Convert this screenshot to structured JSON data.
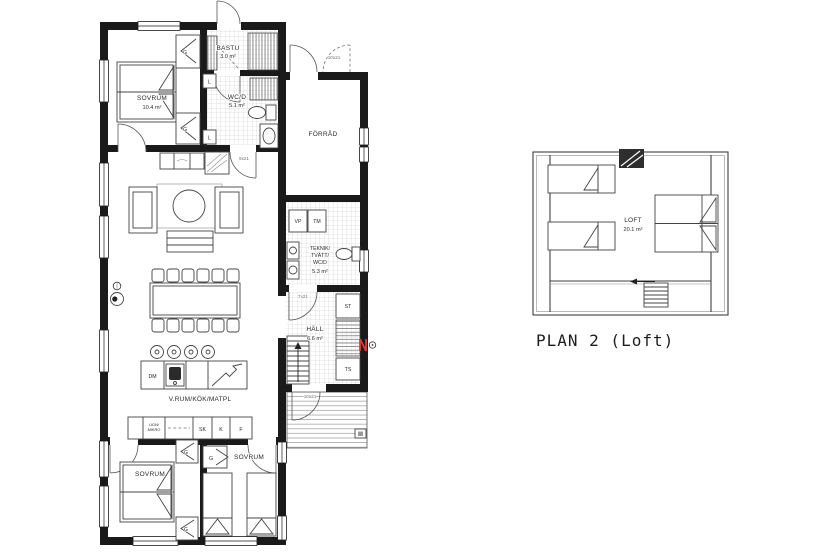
{
  "drawing": {
    "background": "#ffffff",
    "wall_color": "#1a1a1a",
    "line_color": "#3a3a3a",
    "tile_color": "#c9c9c9",
    "accent_red": "#e23b2e"
  },
  "plan1": {
    "rooms": {
      "sovrum_nw": {
        "label": "SOVRUM",
        "area": "10.4 m²"
      },
      "bastu": {
        "label": "BASTU",
        "area": "3.0 m²"
      },
      "wcd": {
        "label": "WC/D",
        "area": "5.1 m²"
      },
      "forrad": {
        "label": "FÖRRÅD"
      },
      "teknik": {
        "l1": "TEKNIK/",
        "l2": "TVÄTT/",
        "l3": "WC/D",
        "area": "5.3 m²"
      },
      "hall": {
        "label": "HÄLL",
        "area": "6.6 m²"
      },
      "vrum": {
        "label": "V.RUM/KÖK/MATPL"
      },
      "sovrum_sw": {
        "label": "SOVRUM"
      },
      "sovrum_se": {
        "label": "SOVRUM"
      }
    },
    "fixtures": {
      "vp": "VP",
      "tm": "TM",
      "st": "ST",
      "ts": "TS",
      "dm": "DM",
      "sk": "SK",
      "k": "K",
      "f": "F",
      "ugn": "UGN/",
      "mikro": "MIKRO",
      "g": "G",
      "l": "L"
    },
    "door_marks": {
      "wcd_door": "9x21",
      "forrad_door": "10x21",
      "teknik_door": "7x21",
      "entry_door": "10x21"
    }
  },
  "plan2": {
    "room": {
      "label": "LOFT",
      "area": "20.1 m²"
    },
    "caption": "PLAN 2 (Loft)"
  }
}
